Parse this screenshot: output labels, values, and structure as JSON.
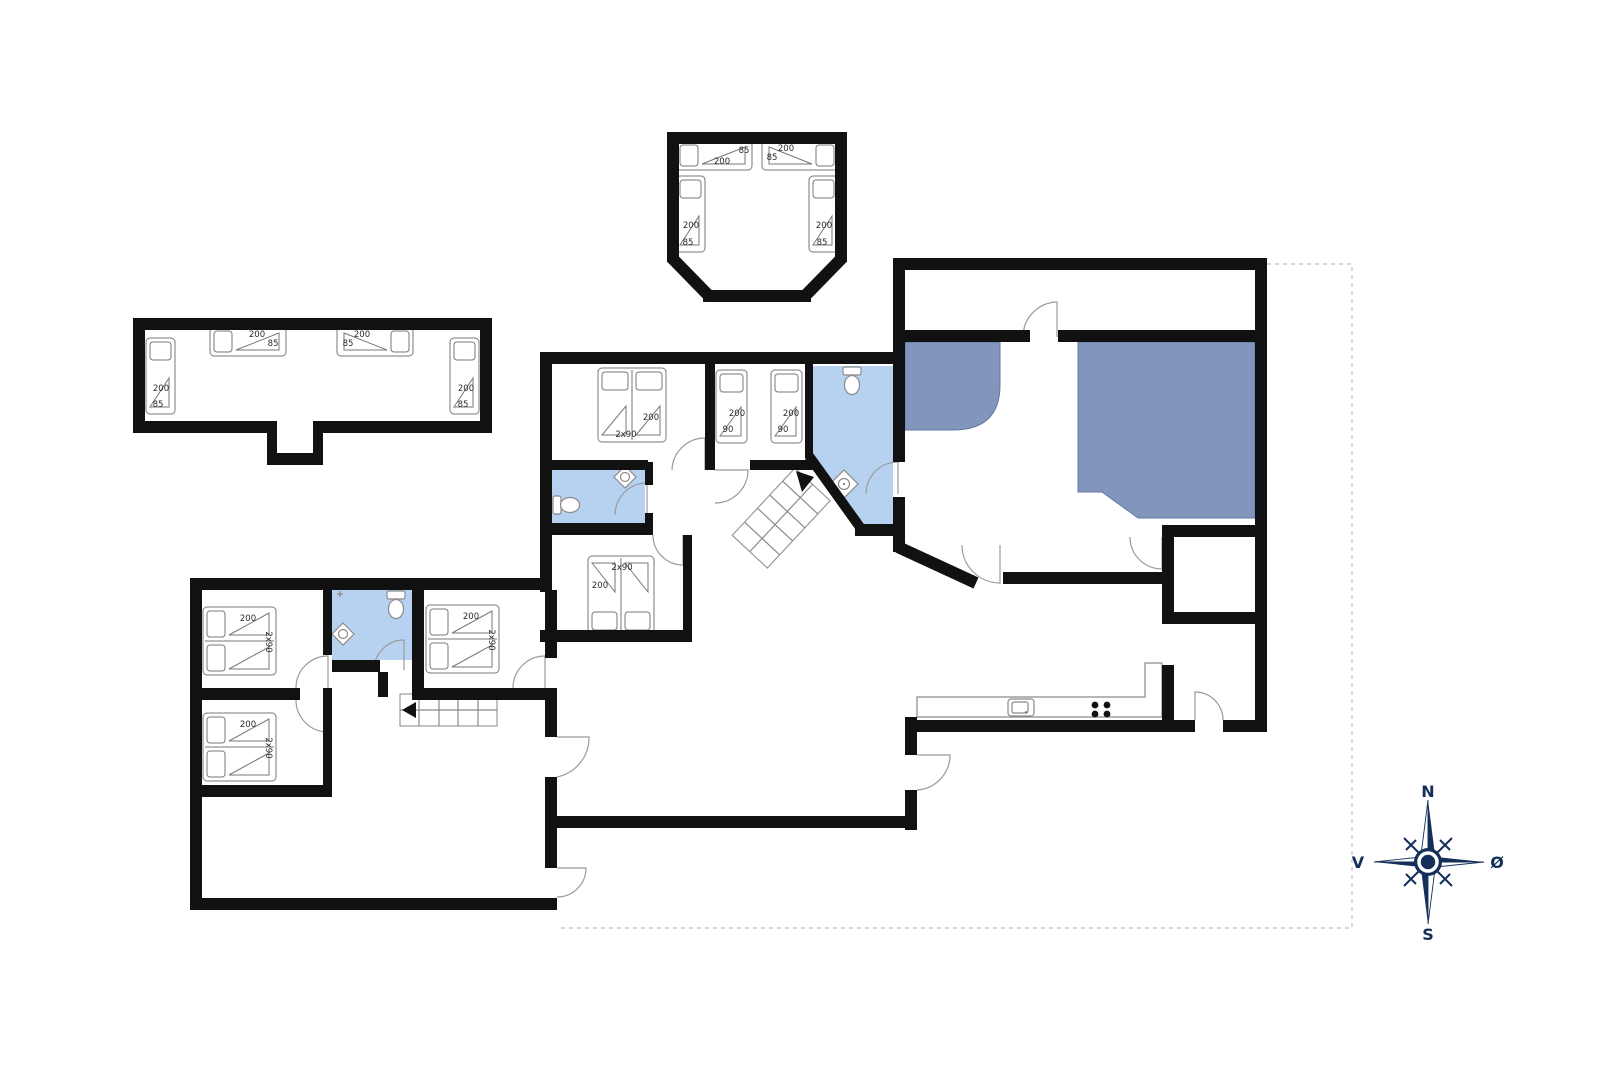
{
  "labels": {
    "l200": "200",
    "l85": "85",
    "l90": "90",
    "l2x90": "2x90"
  },
  "compass": {
    "north": "N",
    "south": "S",
    "west": "V",
    "east": "Ø"
  },
  "colors": {
    "wall": "#111111",
    "bathroom_fill": "#b7d2f1",
    "spa_furniture_fill": "#8296bd",
    "symbol_line": "#8a8a8a",
    "compass_navy": "#14305a",
    "boundary_dash": "#bdbdbd"
  },
  "symbols": [
    "toilet-symbol",
    "sink-symbol",
    "stove-symbol",
    "kitchen-sink-symbol",
    "stairs-symbol",
    "compass-rose"
  ],
  "beds": [
    {
      "x": 676,
      "y": 141,
      "w": 76,
      "h": 29,
      "head": "L",
      "double": false,
      "labels": [
        {
          "k": "l85",
          "x": 744,
          "y": 153
        },
        {
          "k": "l200",
          "x": 722,
          "y": 164
        }
      ]
    },
    {
      "x": 762,
      "y": 141,
      "w": 76,
      "h": 29,
      "head": "R",
      "double": false,
      "labels": [
        {
          "k": "l200",
          "x": 786,
          "y": 151
        },
        {
          "k": "l85",
          "x": 772,
          "y": 160
        }
      ]
    },
    {
      "x": 676,
      "y": 176,
      "w": 29,
      "h": 76,
      "head": "T",
      "double": false,
      "labels": [
        {
          "k": "l200",
          "x": 691,
          "y": 228
        },
        {
          "k": "l85",
          "x": 688,
          "y": 245
        }
      ]
    },
    {
      "x": 809,
      "y": 176,
      "w": 29,
      "h": 76,
      "head": "T",
      "double": false,
      "labels": [
        {
          "k": "l200",
          "x": 824,
          "y": 228
        },
        {
          "k": "l85",
          "x": 822,
          "y": 245
        }
      ]
    },
    {
      "x": 210,
      "y": 327,
      "w": 76,
      "h": 29,
      "head": "L",
      "double": false,
      "labels": [
        {
          "k": "l200",
          "x": 257,
          "y": 337
        },
        {
          "k": "l85",
          "x": 273,
          "y": 346
        }
      ]
    },
    {
      "x": 337,
      "y": 327,
      "w": 76,
      "h": 29,
      "head": "R",
      "double": false,
      "labels": [
        {
          "k": "l200",
          "x": 362,
          "y": 337
        },
        {
          "k": "l85",
          "x": 348,
          "y": 346
        }
      ]
    },
    {
      "x": 146,
      "y": 338,
      "w": 29,
      "h": 76,
      "head": "T",
      "double": false,
      "labels": [
        {
          "k": "l200",
          "x": 161,
          "y": 391
        },
        {
          "k": "l85",
          "x": 158,
          "y": 407
        }
      ]
    },
    {
      "x": 450,
      "y": 338,
      "w": 29,
      "h": 76,
      "head": "T",
      "double": false,
      "labels": [
        {
          "k": "l200",
          "x": 466,
          "y": 391
        },
        {
          "k": "l85",
          "x": 463,
          "y": 407
        }
      ]
    },
    {
      "x": 598,
      "y": 368,
      "w": 68,
      "h": 74,
      "head": "T",
      "double": true,
      "labels": [
        {
          "k": "l200",
          "x": 651,
          "y": 420
        },
        {
          "k": "l2x90",
          "x": 626,
          "y": 437
        }
      ]
    },
    {
      "x": 716,
      "y": 370,
      "w": 31,
      "h": 73,
      "head": "T",
      "double": false,
      "labels": [
        {
          "k": "l200",
          "x": 737,
          "y": 416
        },
        {
          "k": "l90",
          "x": 728,
          "y": 432
        }
      ]
    },
    {
      "x": 771,
      "y": 370,
      "w": 31,
      "h": 73,
      "head": "T",
      "double": false,
      "labels": [
        {
          "k": "l200",
          "x": 791,
          "y": 416
        },
        {
          "k": "l90",
          "x": 783,
          "y": 432
        }
      ]
    },
    {
      "x": 588,
      "y": 556,
      "w": 66,
      "h": 78,
      "head": "B",
      "double": true,
      "labels": [
        {
          "k": "l2x90",
          "x": 622,
          "y": 570
        },
        {
          "k": "l200",
          "x": 600,
          "y": 588
        }
      ]
    },
    {
      "x": 203,
      "y": 607,
      "w": 73,
      "h": 68,
      "head": "L",
      "double": true,
      "labels": [
        {
          "k": "l200",
          "x": 248,
          "y": 621
        },
        {
          "k": "l2x90",
          "x": 266,
          "y": 642,
          "rot": 90
        }
      ]
    },
    {
      "x": 203,
      "y": 713,
      "w": 73,
      "h": 68,
      "head": "L",
      "double": true,
      "labels": [
        {
          "k": "l200",
          "x": 248,
          "y": 727
        },
        {
          "k": "l2x90",
          "x": 266,
          "y": 748,
          "rot": 90
        }
      ]
    },
    {
      "x": 426,
      "y": 605,
      "w": 73,
      "h": 68,
      "head": "L",
      "double": true,
      "labels": [
        {
          "k": "l200",
          "x": 471,
          "y": 619
        },
        {
          "k": "l2x90",
          "x": 489,
          "y": 640,
          "rot": 90
        }
      ]
    }
  ]
}
